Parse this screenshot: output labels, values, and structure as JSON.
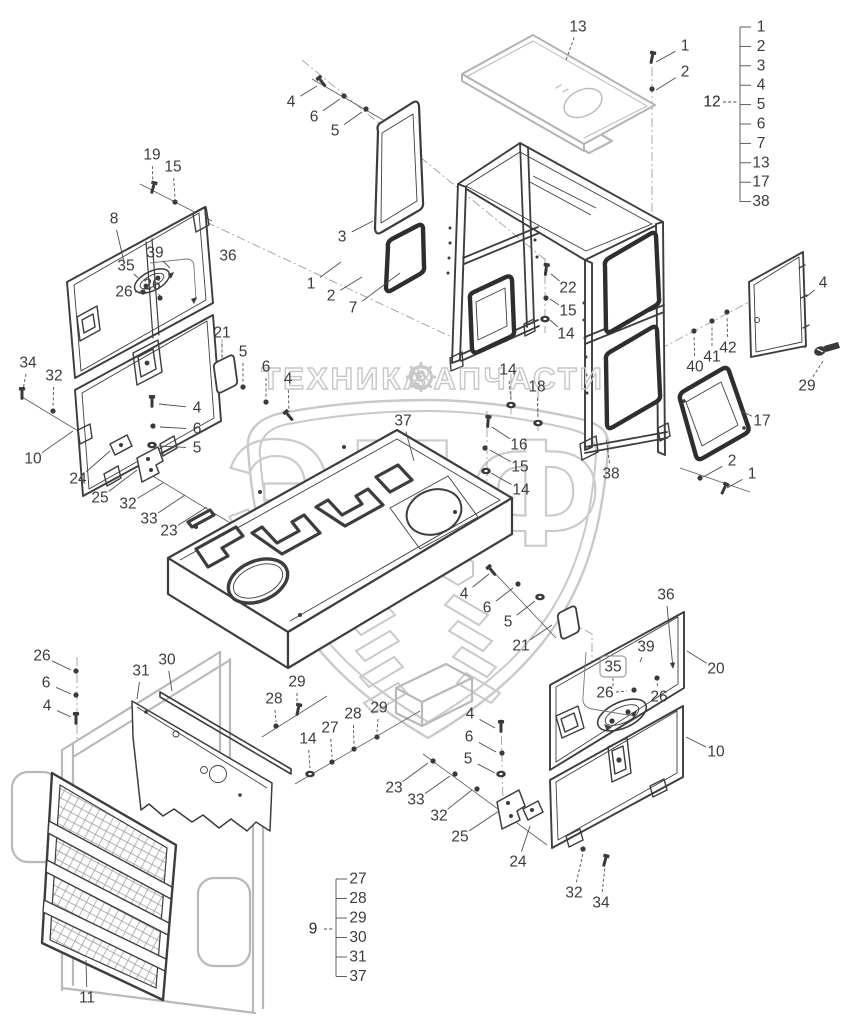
{
  "watermark": {
    "brand": "ЭПФ",
    "tagline_left": "ТЕХНИКА",
    "tagline_right": "ЗАПЧАСТИ",
    "gear_icon": "gear",
    "color": "#c9c9c9"
  },
  "colors": {
    "line": "#3d3d3d",
    "secondary": "#b9b9b9",
    "watermark": "#c9c9c9",
    "label": "#3c3c3c"
  },
  "legends": [
    {
      "label": "12",
      "items": [
        "1",
        "2",
        "3",
        "4",
        "5",
        "6",
        "7",
        "13",
        "17",
        "38"
      ],
      "label_x": 712,
      "label_y": 102,
      "bracket_x": 740,
      "y_start": 27,
      "y_step": 19.4,
      "text_x": 753
    },
    {
      "label": "9",
      "items": [
        "27",
        "28",
        "29",
        "30",
        "31",
        "37"
      ],
      "label_x": 313,
      "label_y": 929,
      "bracket_x": 336,
      "y_start": 879,
      "y_step": 19.5,
      "text_x": 350
    }
  ],
  "callouts": [
    {
      "t": "13",
      "x": 578,
      "y": 27,
      "lx": 566,
      "ly": 60,
      "dash": true
    },
    {
      "t": "1",
      "x": 685,
      "y": 46,
      "lx": 656,
      "ly": 62
    },
    {
      "t": "2",
      "x": 685,
      "y": 72,
      "lx": 656,
      "ly": 90
    },
    {
      "t": "4",
      "x": 291,
      "y": 102,
      "lx": 317,
      "ly": 86
    },
    {
      "t": "6",
      "x": 314,
      "y": 117,
      "lx": 340,
      "ly": 99
    },
    {
      "t": "5",
      "x": 335,
      "y": 131,
      "lx": 362,
      "ly": 112
    },
    {
      "t": "19",
      "x": 152,
      "y": 155,
      "lx": 153,
      "ly": 186,
      "dash": true
    },
    {
      "t": "15",
      "x": 173,
      "y": 167,
      "lx": 175,
      "ly": 199,
      "dash": true
    },
    {
      "t": "8",
      "x": 114,
      "y": 219,
      "lx": 124,
      "ly": 262
    },
    {
      "t": "36",
      "x": 228,
      "y": 256
    },
    {
      "t": "3",
      "x": 342,
      "y": 237,
      "lx": 373,
      "ly": 221
    },
    {
      "t": "39",
      "x": 155,
      "y": 253,
      "lx": 170,
      "ly": 268
    },
    {
      "t": "35",
      "x": 126,
      "y": 266,
      "lx": 138,
      "ly": 278
    },
    {
      "t": "26",
      "x": 124,
      "y": 292,
      "lx": 141,
      "ly": 292
    },
    {
      "t": "26",
      "x": 152,
      "y": 285,
      "lx": 160,
      "ly": 296
    },
    {
      "t": "1",
      "x": 311,
      "y": 284,
      "lx": 341,
      "ly": 262
    },
    {
      "t": "2",
      "x": 331,
      "y": 296,
      "lx": 362,
      "ly": 277
    },
    {
      "t": "7",
      "x": 353,
      "y": 308,
      "lx": 400,
      "ly": 273
    },
    {
      "t": "22",
      "x": 568,
      "y": 288,
      "lx": 551,
      "ly": 274
    },
    {
      "t": "15",
      "x": 568,
      "y": 311,
      "lx": 550,
      "ly": 299
    },
    {
      "t": "14",
      "x": 566,
      "y": 334,
      "lx": 550,
      "ly": 320
    },
    {
      "t": "21",
      "x": 222,
      "y": 333,
      "lx": 222,
      "ly": 360,
      "dash": true
    },
    {
      "t": "5",
      "x": 243,
      "y": 352,
      "lx": 243,
      "ly": 383,
      "dash": true
    },
    {
      "t": "6",
      "x": 266,
      "y": 367,
      "lx": 266,
      "ly": 398,
      "dash": true
    },
    {
      "t": "4",
      "x": 288,
      "y": 379,
      "lx": 289,
      "ly": 412,
      "dash": true
    },
    {
      "t": "34",
      "x": 28,
      "y": 363,
      "lx": 23,
      "ly": 390,
      "dash": true
    },
    {
      "t": "32",
      "x": 54,
      "y": 376,
      "lx": 53,
      "ly": 407,
      "dash": true
    },
    {
      "t": "4",
      "x": 197,
      "y": 408,
      "lx": 159,
      "ly": 404
    },
    {
      "t": "6",
      "x": 197,
      "y": 429,
      "lx": 160,
      "ly": 427
    },
    {
      "t": "5",
      "x": 197,
      "y": 448,
      "lx": 159,
      "ly": 446
    },
    {
      "t": "10",
      "x": 33,
      "y": 459,
      "lx": 73,
      "ly": 431
    },
    {
      "t": "24",
      "x": 78,
      "y": 479,
      "lx": 110,
      "ly": 451
    },
    {
      "t": "25",
      "x": 100,
      "y": 498,
      "lx": 137,
      "ly": 470
    },
    {
      "t": "32",
      "x": 128,
      "y": 504,
      "lx": 163,
      "ly": 483
    },
    {
      "t": "33",
      "x": 149,
      "y": 519,
      "lx": 185,
      "ly": 495
    },
    {
      "t": "23",
      "x": 169,
      "y": 531,
      "lx": 207,
      "ly": 507
    },
    {
      "t": "37",
      "x": 403,
      "y": 421,
      "lx": 414,
      "ly": 461
    },
    {
      "t": "14",
      "x": 508,
      "y": 370,
      "lx": 511,
      "ly": 400,
      "dash": true
    },
    {
      "t": "18",
      "x": 537,
      "y": 387,
      "lx": 538,
      "ly": 417,
      "dash": true
    },
    {
      "t": "16",
      "x": 519,
      "y": 445,
      "lx": 492,
      "ly": 427
    },
    {
      "t": "15",
      "x": 520,
      "y": 467,
      "lx": 490,
      "ly": 450
    },
    {
      "t": "14",
      "x": 521,
      "y": 490,
      "lx": 491,
      "ly": 473
    },
    {
      "t": "40",
      "x": 695,
      "y": 367,
      "lx": 694,
      "ly": 336,
      "dash": true
    },
    {
      "t": "41",
      "x": 712,
      "y": 357,
      "lx": 712,
      "ly": 325,
      "dash": true
    },
    {
      "t": "42",
      "x": 728,
      "y": 348,
      "lx": 727,
      "ly": 316,
      "dash": true
    },
    {
      "t": "4",
      "x": 823,
      "y": 283,
      "lx": 806,
      "ly": 297
    },
    {
      "t": "29",
      "x": 807,
      "y": 386,
      "lx": 823,
      "ly": 361,
      "dash": true
    },
    {
      "t": "17",
      "x": 762,
      "y": 421,
      "lx": 741,
      "ly": 411
    },
    {
      "t": "2",
      "x": 732,
      "y": 461,
      "lx": 703,
      "ly": 477
    },
    {
      "t": "1",
      "x": 752,
      "y": 474,
      "lx": 727,
      "ly": 488
    },
    {
      "t": "38",
      "x": 611,
      "y": 474,
      "lx": 606,
      "ly": 437,
      "dash": true
    },
    {
      "t": "4",
      "x": 464,
      "y": 594,
      "lx": 489,
      "ly": 574
    },
    {
      "t": "6",
      "x": 487,
      "y": 608,
      "lx": 513,
      "ly": 588
    },
    {
      "t": "5",
      "x": 508,
      "y": 622,
      "lx": 535,
      "ly": 601
    },
    {
      "t": "21",
      "x": 521,
      "y": 646,
      "lx": 552,
      "ly": 625
    },
    {
      "t": "36",
      "x": 666,
      "y": 595,
      "lx": 673,
      "ly": 668,
      "arrow": true
    },
    {
      "t": "20",
      "x": 716,
      "y": 669,
      "lx": 687,
      "ly": 651
    },
    {
      "t": "39",
      "x": 646,
      "y": 647,
      "lx": 640,
      "ly": 662
    },
    {
      "t": "35",
      "x": 613,
      "y": 667,
      "boxed": true,
      "lx": 613,
      "ly": 688,
      "dash": true
    },
    {
      "t": "26",
      "x": 605,
      "y": 693,
      "lx": 627,
      "ly": 691,
      "dash": true
    },
    {
      "t": "26",
      "x": 659,
      "y": 697,
      "lx": 657,
      "ly": 682,
      "dash": true
    },
    {
      "t": "10",
      "x": 716,
      "y": 752,
      "lx": 686,
      "ly": 737
    },
    {
      "t": "4",
      "x": 470,
      "y": 714,
      "lx": 495,
      "ly": 728
    },
    {
      "t": "6",
      "x": 469,
      "y": 737,
      "lx": 496,
      "ly": 752
    },
    {
      "t": "5",
      "x": 468,
      "y": 759,
      "lx": 495,
      "ly": 773
    },
    {
      "t": "23",
      "x": 394,
      "y": 788,
      "lx": 428,
      "ly": 763
    },
    {
      "t": "33",
      "x": 416,
      "y": 800,
      "lx": 450,
      "ly": 776
    },
    {
      "t": "32",
      "x": 439,
      "y": 816,
      "lx": 472,
      "ly": 790
    },
    {
      "t": "25",
      "x": 460,
      "y": 837,
      "lx": 499,
      "ly": 811
    },
    {
      "t": "24",
      "x": 518,
      "y": 862,
      "lx": 530,
      "ly": 826
    },
    {
      "t": "32",
      "x": 574,
      "y": 893,
      "lx": 583,
      "ly": 853,
      "dash": true
    },
    {
      "t": "34",
      "x": 601,
      "y": 903,
      "lx": 605,
      "ly": 866,
      "dash": true
    },
    {
      "t": "26",
      "x": 42,
      "y": 656,
      "lx": 71,
      "ly": 670
    },
    {
      "t": "6",
      "x": 46,
      "y": 683,
      "lx": 71,
      "ly": 694
    },
    {
      "t": "4",
      "x": 47,
      "y": 706,
      "lx": 71,
      "ly": 717
    },
    {
      "t": "31",
      "x": 141,
      "y": 671,
      "lx": 137,
      "ly": 699
    },
    {
      "t": "30",
      "x": 167,
      "y": 660,
      "lx": 172,
      "ly": 691
    },
    {
      "t": "29",
      "x": 297,
      "y": 682,
      "lx": 297,
      "ly": 706,
      "dash": true
    },
    {
      "t": "28",
      "x": 274,
      "y": 699,
      "lx": 276,
      "ly": 722,
      "dash": true
    },
    {
      "t": "14",
      "x": 308,
      "y": 739,
      "lx": 310,
      "ly": 768,
      "dash": true
    },
    {
      "t": "27",
      "x": 330,
      "y": 728,
      "lx": 332,
      "ly": 757,
      "dash": true
    },
    {
      "t": "28",
      "x": 353,
      "y": 714,
      "lx": 354,
      "ly": 744,
      "dash": true
    },
    {
      "t": "29",
      "x": 379,
      "y": 708,
      "lx": 377,
      "ly": 732,
      "dash": true
    },
    {
      "t": "11",
      "x": 87,
      "y": 998,
      "lx": 86,
      "ly": 960
    },
    {
      "t": "9",
      "x": 313,
      "y": 929,
      "lx": 334,
      "ly": 929,
      "dash": true
    },
    {
      "t": "12",
      "x": 712,
      "y": 102,
      "lx": 738,
      "ly": 102,
      "dash": true
    }
  ]
}
